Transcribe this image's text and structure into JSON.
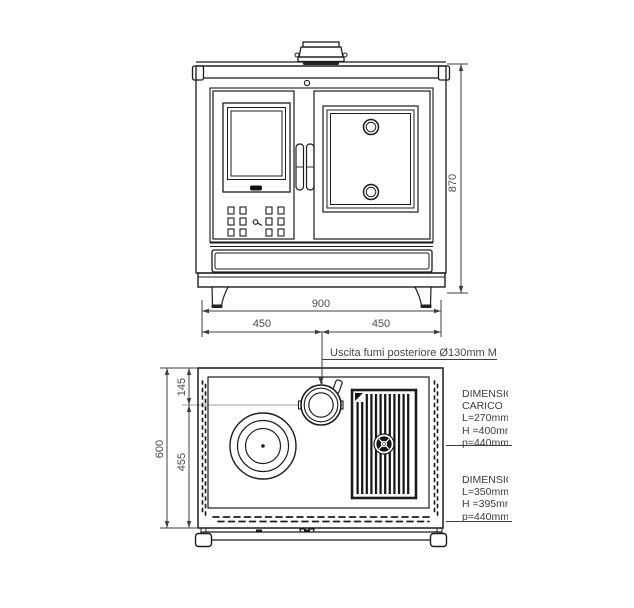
{
  "drawing": {
    "front_view": {
      "height_dim": "870",
      "width_dim": "900",
      "width_left_dim": "450",
      "width_right_dim": "450"
    },
    "plan_view": {
      "depth_dim": "600",
      "flue_center_dim": "145",
      "rear_dim": "455",
      "flue_label": "Uscita fumi posteriore Ø130mm M"
    },
    "spec_blocks": [
      {
        "lines": [
          "DIMENSIONI",
          "CARICO",
          "L=270mm",
          "H =400mm",
          "p=440mm"
        ]
      },
      {
        "lines": [
          "DIMENSIONI",
          "L=350mm",
          "H =395mm",
          "p=440mm"
        ]
      }
    ],
    "colors": {
      "line": "#1c1c1c",
      "dim_text": "#4d4d4d",
      "centerline": "#b5b5b5",
      "background": "#ffffff"
    }
  }
}
